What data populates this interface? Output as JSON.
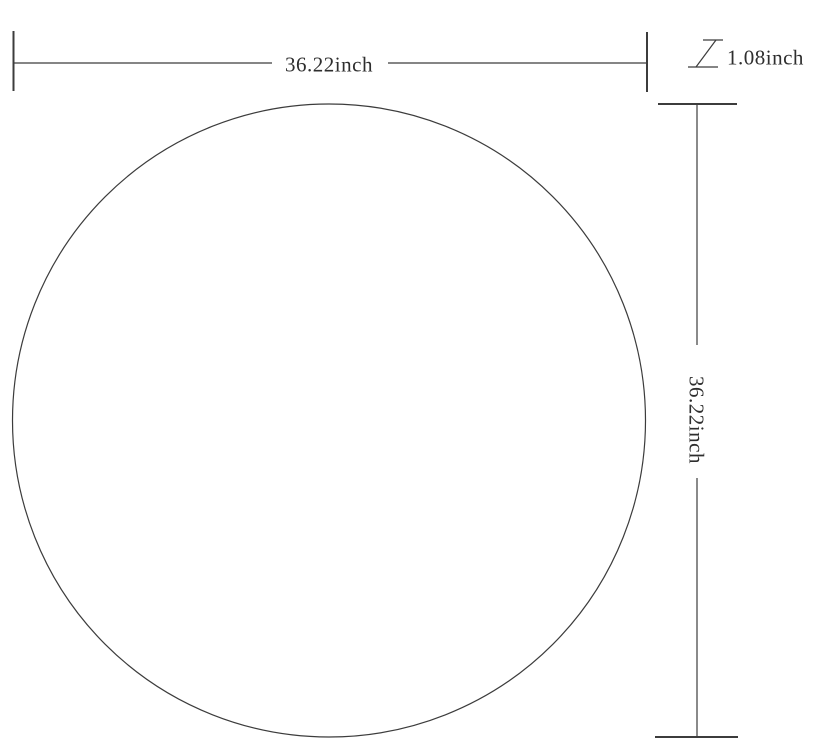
{
  "diagram": {
    "shape": "circle",
    "colors": {
      "background": "#ffffff",
      "line": "#3c3c3c",
      "text": "#2e2e2e"
    },
    "dimensions": {
      "width": "36.22inch",
      "thickness": "1.08inch",
      "height": "36.22inch"
    }
  }
}
